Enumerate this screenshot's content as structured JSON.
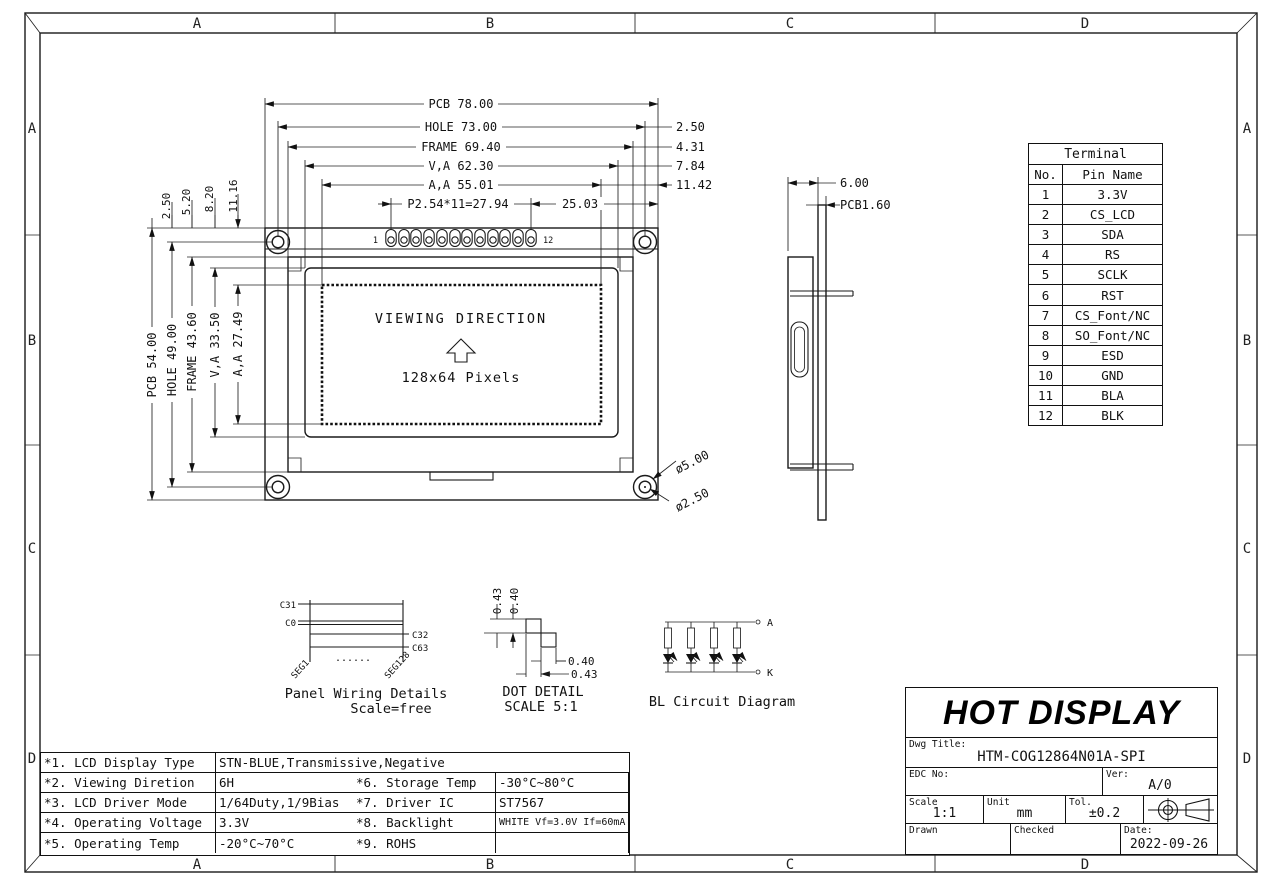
{
  "zones": {
    "top": [
      "A",
      "B",
      "C",
      "D"
    ],
    "bottom": [
      "A",
      "B",
      "C",
      "D"
    ],
    "left": [
      "A",
      "B",
      "C",
      "D"
    ],
    "right": [
      "A",
      "B",
      "C",
      "D"
    ]
  },
  "front": {
    "dim_pcb_w": "PCB 78.00",
    "dim_hole_w": "HOLE 73.00",
    "dim_frame_w": "FRAME 69.40",
    "dim_va_w": "V,A 62.30",
    "dim_aa_w": "A,A 55.01",
    "dim_pitch": "P2.54*11=27.94",
    "dim_2503": "25.03",
    "off_right": [
      "2.50",
      "4.31",
      "7.84",
      "11.42"
    ],
    "dim_pcb_h": "PCB 54.00",
    "dim_hole_h": "HOLE 49.00",
    "dim_frame_h": "FRAME 43.60",
    "dim_va_h": "V,A 33.50",
    "dim_aa_h": "A,A 27.49",
    "off_top": [
      "2.50",
      "5.20",
      "8.20",
      "11.16"
    ],
    "pin1": "1",
    "pin12": "12",
    "viewing": "VIEWING DIRECTION",
    "pixels": "128x64 Pixels",
    "dia_outer": "ø5.00",
    "dia_inner": "ø2.50"
  },
  "side": {
    "depth": "6.00",
    "pcb": "PCB1.60"
  },
  "terminal": {
    "title": "Terminal",
    "no": "No.",
    "pin": "Pin Name",
    "rows": [
      [
        "1",
        "3.3V"
      ],
      [
        "2",
        "CS_LCD"
      ],
      [
        "3",
        "SDA"
      ],
      [
        "4",
        "RS"
      ],
      [
        "5",
        "SCLK"
      ],
      [
        "6",
        "RST"
      ],
      [
        "7",
        "CS_Font/NC"
      ],
      [
        "8",
        "SO_Font/NC"
      ],
      [
        "9",
        "ESD"
      ],
      [
        "10",
        "GND"
      ],
      [
        "11",
        "BLA"
      ],
      [
        "12",
        "BLK"
      ]
    ]
  },
  "wiring": {
    "c31": "C31",
    "c0": "C0",
    "c32": "C32",
    "c63": "C63",
    "seg1": "SEG1",
    "seg128": "SEG128",
    "dots": "......",
    "cap1": "Panel Wiring Details",
    "cap2": "Scale=free"
  },
  "dot": {
    "t1": "0.43",
    "t2": "0.40",
    "r1": "0.40",
    "r2": "0.43",
    "cap1": "DOT DETAIL",
    "cap2": "SCALE 5:1"
  },
  "bl": {
    "a": "A",
    "k": "K",
    "cap": "BL Circuit Diagram"
  },
  "spec": {
    "r1l": "*1. LCD Display Type",
    "r1v": "STN-BLUE,Transmissive,Negative",
    "rows": [
      {
        "l1": "*2. Viewing Diretion",
        "v1": "6H",
        "l2": "*6. Storage Temp",
        "v2": "-30°C~80°C"
      },
      {
        "l1": "*3. LCD Driver Mode",
        "v1": "1/64Duty,1/9Bias",
        "l2": "*7. Driver IC",
        "v2": "ST7567"
      },
      {
        "l1": "*4. Operating Voltage",
        "v1": "3.3V",
        "l2": "*8. Backlight",
        "v2": "WHITE Vf=3.0V If=60mA"
      },
      {
        "l1": "*5. Operating Temp",
        "v1": "-20°C~70°C",
        "l2": "*9. ROHS",
        "v2": ""
      }
    ]
  },
  "title_block": {
    "company": "HOT DISPLAY",
    "dwg_label": "Dwg Title:",
    "dwg": "HTM-COG12864N01A-SPI",
    "edc": "EDC No:",
    "ver_label": "Ver:",
    "ver": "A/0",
    "scale_label": "Scale",
    "scale": "1:1",
    "unit_label": "Unit",
    "unit": "mm",
    "tol_label": "Tol.",
    "tol": "±0.2",
    "drawn": "Drawn",
    "checked": "Checked",
    "date_label": "Date:",
    "date": "2022-09-26"
  }
}
